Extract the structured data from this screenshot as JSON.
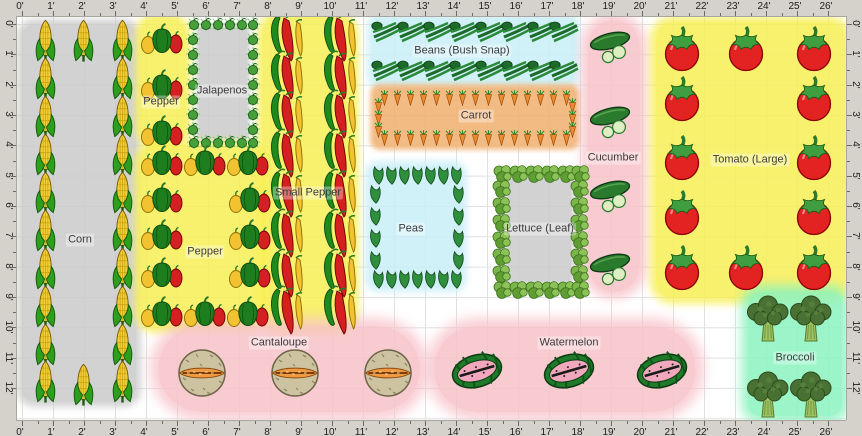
{
  "rulers": {
    "top": [
      "0'",
      "1'",
      "2'",
      "3'",
      "4'",
      "5'",
      "6'",
      "7'",
      "8'",
      "9'",
      "10'",
      "11'",
      "12'",
      "13'",
      "14'",
      "15'",
      "16'",
      "17'",
      "18'",
      "19'",
      "20'",
      "21'",
      "22'",
      "23'",
      "24'",
      "25'",
      "26'"
    ],
    "bottom": [
      "0'",
      "1'",
      "2'",
      "3'",
      "4'",
      "5'",
      "6'",
      "7'",
      "8'",
      "9'",
      "10'",
      "11'",
      "12'",
      "13'",
      "14'",
      "15'",
      "16'",
      "17'",
      "18'",
      "19'",
      "20'",
      "21'",
      "22'",
      "23'",
      "24'",
      "25'",
      "26'"
    ],
    "left": [
      "0'",
      "1'",
      "2'",
      "3'",
      "4'",
      "5'",
      "6'",
      "7'",
      "8'",
      "9'",
      "10'",
      "11'",
      "12'"
    ],
    "right": [
      "0'",
      "1'",
      "2'",
      "3'",
      "4'",
      "5'",
      "6'",
      "7'",
      "8'",
      "9'",
      "10'",
      "11'",
      "12'"
    ]
  },
  "colors": {
    "ruler_bg": "#d5d2cc",
    "grid_line": "#e0e0e0",
    "bed_yellow": "#f7ef55",
    "bed_gray": "#cacaca",
    "bed_cyan": "#c7eef6",
    "bed_orange": "#f1af6e",
    "bed_pink": "#f7c2c9",
    "bed_mint": "#8bf2bf"
  },
  "beds": [
    {
      "name": "corn",
      "label": "Corn",
      "color": "#cacaca",
      "glow": 7,
      "rect": {
        "x": 22,
        "y": 24,
        "w": 114,
        "h": 378,
        "r": 12
      },
      "label_xy": [
        80,
        240
      ],
      "icon": {
        "type": "corn",
        "size": [
          23,
          43
        ],
        "points": [
          [
            45,
            40
          ],
          [
            45,
            78
          ],
          [
            45,
            116
          ],
          [
            45,
            154
          ],
          [
            45,
            192
          ],
          [
            45,
            230
          ],
          [
            45,
            268
          ],
          [
            45,
            306
          ],
          [
            45,
            344
          ],
          [
            45,
            381
          ],
          [
            122,
            40
          ],
          [
            122,
            78
          ],
          [
            122,
            116
          ],
          [
            122,
            154
          ],
          [
            122,
            192
          ],
          [
            122,
            230
          ],
          [
            122,
            268
          ],
          [
            122,
            306
          ],
          [
            122,
            344
          ],
          [
            122,
            381
          ],
          [
            83,
            40
          ],
          [
            83,
            384
          ]
        ]
      }
    },
    {
      "name": "pepper-top",
      "label": "Pepper",
      "color": "#f7ef55",
      "glow": 7,
      "rect": {
        "x": 140,
        "y": 18,
        "w": 46,
        "h": 127,
        "r": 16
      },
      "label_xy": [
        161,
        102
      ],
      "icon": {
        "type": "pepper",
        "size": [
          44,
          34
        ],
        "points": [
          [
            162,
            38
          ],
          [
            162,
            84
          ],
          [
            162,
            130
          ]
        ]
      }
    },
    {
      "name": "jalapenos",
      "label": "Jalapenos",
      "color": "#cacaca",
      "glow": 4,
      "rect": {
        "x": 199,
        "y": 28,
        "w": 48,
        "h": 110,
        "r": 3
      },
      "label_xy": [
        222,
        91
      ],
      "icon": {
        "type": "jalapeno",
        "size": [
          14,
          14
        ],
        "points": [
          [
            194,
            24
          ],
          [
            206,
            24
          ],
          [
            218,
            24
          ],
          [
            230,
            24
          ],
          [
            242,
            24
          ],
          [
            253,
            24
          ],
          [
            194,
            142
          ],
          [
            206,
            142
          ],
          [
            218,
            142
          ],
          [
            230,
            142
          ],
          [
            242,
            142
          ],
          [
            253,
            142
          ],
          [
            193,
            39
          ],
          [
            193,
            54
          ],
          [
            193,
            69
          ],
          [
            193,
            84
          ],
          [
            193,
            99
          ],
          [
            193,
            114
          ],
          [
            193,
            129
          ],
          [
            253,
            39
          ],
          [
            253,
            54
          ],
          [
            253,
            69
          ],
          [
            253,
            84
          ],
          [
            253,
            99
          ],
          [
            253,
            114
          ],
          [
            253,
            129
          ]
        ]
      }
    },
    {
      "name": "pepper-main",
      "label": "Pepper",
      "color": "#f7ef55",
      "glow": 7,
      "rect": {
        "x": 139,
        "y": 146,
        "w": 126,
        "h": 182,
        "r": 16
      },
      "label_xy": [
        205,
        252
      ],
      "icon": {
        "type": "pepper",
        "size": [
          44,
          34
        ],
        "points": [
          [
            162,
            160
          ],
          [
            205,
            160
          ],
          [
            248,
            160
          ],
          [
            162,
            197
          ],
          [
            250,
            197
          ],
          [
            162,
            234
          ],
          [
            250,
            234
          ],
          [
            162,
            272
          ],
          [
            250,
            272
          ],
          [
            162,
            311
          ],
          [
            205,
            311
          ],
          [
            248,
            311
          ]
        ]
      }
    },
    {
      "name": "small-pepper",
      "label": "Small Pepper",
      "color": "#f7ef55",
      "glow": 7,
      "rect": {
        "x": 262,
        "y": 16,
        "w": 92,
        "h": 314,
        "r": 18
      },
      "label_xy": [
        308,
        193
      ],
      "icon": {
        "type": "chili",
        "size": [
          38,
          52
        ],
        "points": [
          [
            286,
            37
          ],
          [
            286,
            75
          ],
          [
            286,
            114
          ],
          [
            286,
            153
          ],
          [
            286,
            193
          ],
          [
            286,
            233
          ],
          [
            286,
            273
          ],
          [
            286,
            310
          ],
          [
            339,
            37
          ],
          [
            339,
            75
          ],
          [
            339,
            114
          ],
          [
            339,
            153
          ],
          [
            339,
            193
          ],
          [
            339,
            233
          ],
          [
            339,
            273
          ],
          [
            339,
            310
          ]
        ]
      }
    },
    {
      "name": "beans",
      "label": "Beans (Bush Snap)",
      "color": "#c7eef6",
      "glow": 7,
      "rect": {
        "x": 372,
        "y": 18,
        "w": 203,
        "h": 65,
        "r": 8
      },
      "label_xy": [
        462,
        51
      ],
      "icon": {
        "type": "bean",
        "size": [
          30,
          22
        ],
        "points": [
          [
            386,
            32
          ],
          [
            412,
            32
          ],
          [
            438,
            32
          ],
          [
            464,
            32
          ],
          [
            490,
            32
          ],
          [
            516,
            32
          ],
          [
            542,
            32
          ],
          [
            564,
            32
          ],
          [
            386,
            71
          ],
          [
            412,
            71
          ],
          [
            438,
            71
          ],
          [
            464,
            71
          ],
          [
            490,
            71
          ],
          [
            516,
            71
          ],
          [
            542,
            71
          ],
          [
            564,
            71
          ]
        ]
      }
    },
    {
      "name": "carrot",
      "label": "Carrot",
      "color": "#f1af6e",
      "glow": 5,
      "rect": {
        "x": 374,
        "y": 88,
        "w": 202,
        "h": 58,
        "r": 6
      },
      "label_xy": [
        476,
        116
      ],
      "icon": {
        "type": "carrot",
        "size": [
          9,
          16
        ],
        "points": [
          [
            384,
            98
          ],
          [
            397,
            98
          ],
          [
            410,
            98
          ],
          [
            423,
            98
          ],
          [
            436,
            98
          ],
          [
            449,
            98
          ],
          [
            462,
            98
          ],
          [
            475,
            98
          ],
          [
            488,
            98
          ],
          [
            501,
            98
          ],
          [
            514,
            98
          ],
          [
            527,
            98
          ],
          [
            540,
            98
          ],
          [
            553,
            98
          ],
          [
            566,
            98
          ],
          [
            384,
            138
          ],
          [
            397,
            138
          ],
          [
            410,
            138
          ],
          [
            423,
            138
          ],
          [
            436,
            138
          ],
          [
            449,
            138
          ],
          [
            462,
            138
          ],
          [
            475,
            138
          ],
          [
            488,
            138
          ],
          [
            501,
            138
          ],
          [
            514,
            138
          ],
          [
            527,
            138
          ],
          [
            540,
            138
          ],
          [
            553,
            138
          ],
          [
            566,
            138
          ],
          [
            378,
            106
          ],
          [
            378,
            118
          ],
          [
            378,
            130
          ],
          [
            572,
            106
          ],
          [
            572,
            118
          ],
          [
            572,
            130
          ]
        ]
      }
    },
    {
      "name": "peas",
      "label": "Peas",
      "color": "#c7eef6",
      "glow": 7,
      "rect": {
        "x": 370,
        "y": 166,
        "w": 92,
        "h": 121,
        "r": 8
      },
      "label_xy": [
        411,
        229
      ],
      "icon": {
        "type": "pea",
        "size": [
          13,
          19
        ],
        "points": [
          [
            378,
            175
          ],
          [
            391,
            175
          ],
          [
            404,
            175
          ],
          [
            417,
            175
          ],
          [
            430,
            175
          ],
          [
            443,
            175
          ],
          [
            456,
            175
          ],
          [
            378,
            279
          ],
          [
            391,
            279
          ],
          [
            404,
            279
          ],
          [
            417,
            279
          ],
          [
            430,
            279
          ],
          [
            443,
            279
          ],
          [
            456,
            279
          ],
          [
            375,
            194
          ],
          [
            375,
            216
          ],
          [
            375,
            238
          ],
          [
            375,
            260
          ],
          [
            458,
            194
          ],
          [
            458,
            216
          ],
          [
            458,
            238
          ],
          [
            458,
            260
          ]
        ]
      }
    },
    {
      "name": "lettuce",
      "label": "Lettuce (Leaf)",
      "color": "#cacaca",
      "glow": 4,
      "rect": {
        "x": 508,
        "y": 180,
        "w": 63,
        "h": 101,
        "r": 3
      },
      "label_xy": [
        540,
        229
      ],
      "icon": {
        "type": "lettuce",
        "size": [
          19,
          19
        ],
        "points": [
          [
            502,
            173
          ],
          [
            518,
            173
          ],
          [
            534,
            173
          ],
          [
            550,
            173
          ],
          [
            566,
            173
          ],
          [
            580,
            173
          ],
          [
            502,
            289
          ],
          [
            518,
            289
          ],
          [
            534,
            289
          ],
          [
            550,
            289
          ],
          [
            566,
            289
          ],
          [
            580,
            289
          ],
          [
            501,
            188
          ],
          [
            501,
            205
          ],
          [
            501,
            222
          ],
          [
            501,
            239
          ],
          [
            501,
            256
          ],
          [
            501,
            273
          ],
          [
            579,
            188
          ],
          [
            579,
            205
          ],
          [
            579,
            222
          ],
          [
            579,
            239
          ],
          [
            579,
            256
          ],
          [
            579,
            273
          ]
        ]
      }
    },
    {
      "name": "cucumber",
      "label": "Cucumber",
      "color": "#f7c2c9",
      "glow": 10,
      "rect": {
        "x": 588,
        "y": 20,
        "w": 52,
        "h": 272,
        "r": 26
      },
      "label_xy": [
        613,
        158
      ],
      "icon": {
        "type": "cuke",
        "size": [
          48,
          38
        ],
        "points": [
          [
            612,
            47
          ],
          [
            612,
            122
          ],
          [
            612,
            196
          ],
          [
            612,
            269
          ]
        ]
      }
    },
    {
      "name": "tomato",
      "label": "Tomato (Large)",
      "color": "#f7ef55",
      "glow": 8,
      "rect": {
        "x": 656,
        "y": 22,
        "w": 189,
        "h": 276,
        "r": 16
      },
      "label_xy": [
        750,
        160
      ],
      "icon": {
        "type": "tomato",
        "size": [
          42,
          46
        ],
        "points": [
          [
            682,
            49
          ],
          [
            746,
            49
          ],
          [
            814,
            49
          ],
          [
            682,
            99
          ],
          [
            814,
            99
          ],
          [
            682,
            158
          ],
          [
            814,
            158
          ],
          [
            682,
            213
          ],
          [
            814,
            213
          ],
          [
            682,
            268
          ],
          [
            746,
            268
          ],
          [
            814,
            268
          ]
        ]
      }
    },
    {
      "name": "cantaloupe",
      "label": "Cantaloupe",
      "color": "#f7c2c9",
      "glow": 12,
      "rect": {
        "x": 158,
        "y": 326,
        "w": 262,
        "h": 86,
        "r": 43
      },
      "label_xy": [
        279,
        343
      ],
      "icon": {
        "type": "cantaloupe",
        "size": [
          52,
          50
        ],
        "points": [
          [
            202,
            373
          ],
          [
            295,
            373
          ],
          [
            388,
            373
          ]
        ]
      }
    },
    {
      "name": "watermelon",
      "label": "Watermelon",
      "color": "#f7c2c9",
      "glow": 12,
      "rect": {
        "x": 434,
        "y": 326,
        "w": 262,
        "h": 86,
        "r": 43
      },
      "label_xy": [
        569,
        343
      ],
      "icon": {
        "type": "melon",
        "size": [
          54,
          44
        ],
        "points": [
          [
            477,
            371
          ],
          [
            569,
            371
          ],
          [
            662,
            371
          ]
        ]
      }
    },
    {
      "name": "broccoli",
      "label": "Broccoli",
      "color": "#8bf2bf",
      "glow": 10,
      "rect": {
        "x": 748,
        "y": 292,
        "w": 94,
        "h": 124,
        "r": 12
      },
      "label_xy": [
        795,
        358
      ],
      "icon": {
        "type": "broccoli",
        "size": [
          46,
          50
        ],
        "points": [
          [
            768,
            320
          ],
          [
            811,
            320
          ],
          [
            768,
            396
          ],
          [
            811,
            396
          ]
        ]
      }
    }
  ]
}
